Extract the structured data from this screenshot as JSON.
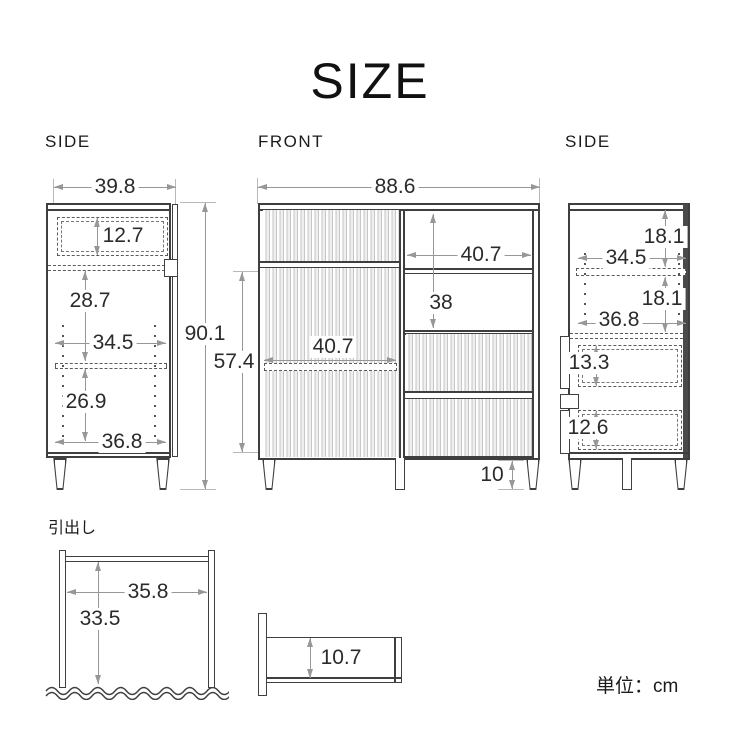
{
  "title": "SIZE",
  "unit": "単位：cm",
  "view_labels": {
    "side_left": "SIDE",
    "front": "FRONT",
    "side_right": "SIDE"
  },
  "drawer_label": "引出し",
  "dims": {
    "side_left": {
      "width": "39.8",
      "top_drawer_height": "12.7",
      "upper_inner_height": "28.7",
      "inner_depth": "34.5",
      "lower_inner_height": "26.9",
      "base_depth": "36.8"
    },
    "front": {
      "width": "88.6",
      "total_height": "90.1",
      "door_section_height": "57.4",
      "open_inner_width": "40.7",
      "open_inner_height": "38",
      "door_inner_width": "40.7",
      "leg_height": "10"
    },
    "side_right": {
      "upper_compartment_height": "18.1",
      "inner_depth": "34.5",
      "lower_compartment_height": "18.1",
      "base_depth": "36.8",
      "top_drawer_height": "13.3",
      "bottom_drawer_height": "12.6"
    },
    "drawer": {
      "inner_width": "35.8",
      "inner_depth": "33.5",
      "inner_height": "10.7"
    }
  },
  "colors": {
    "outline": "#3f3f3f",
    "dimension": "#979797",
    "text": "#2b2b2b",
    "background": "#ffffff"
  }
}
